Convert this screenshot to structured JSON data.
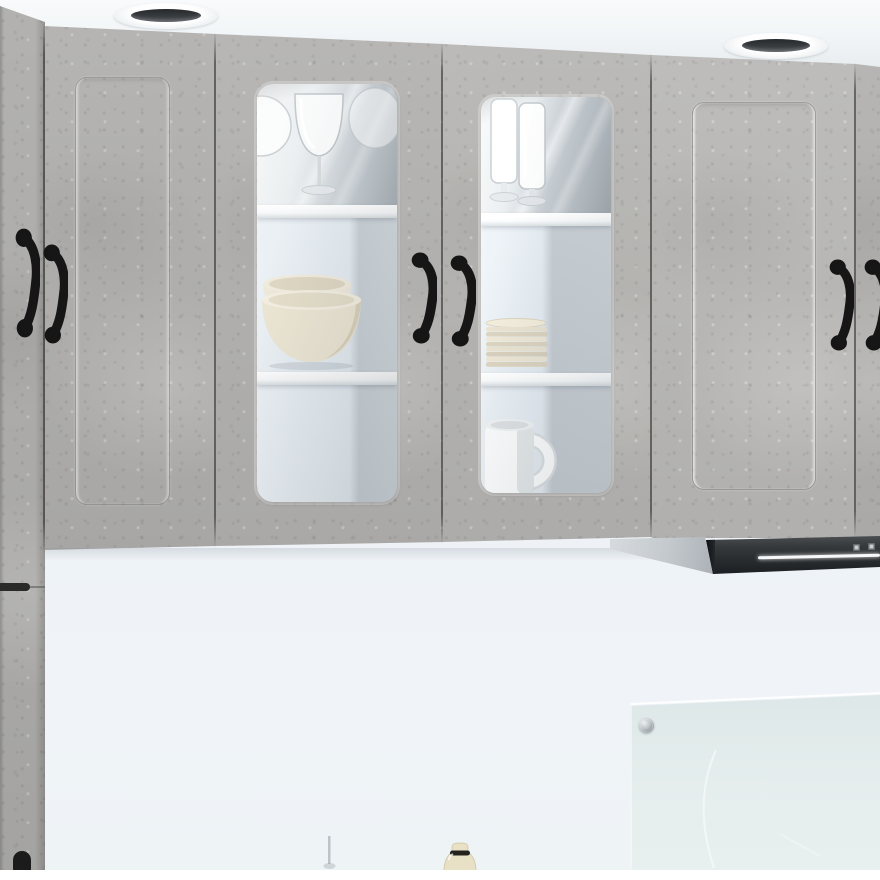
{
  "scene": {
    "label": "kitchen-cabinet-product-photo",
    "description": "Product photo of wall-mounted kitchen cabinets in a concrete-grey finish: two glass-front display doors with white shelves holding glassware and crockery, flanked by plain framed doors with black retro pull handles; a tall cabinet at the left edge, two recessed ceiling spotlights above, a black extractor hood with LED strip at lower right, and a glass splashback over a pale blue-white wall.",
    "text_visible": false,
    "image_width_px": 880,
    "image_height_px": 880
  },
  "palette": {
    "concrete_grey": "#b3b2b0",
    "ceiling_white": "#f4f7f8",
    "wall_light_blue": "#edf2f6",
    "shelf_white": "#fafbfc",
    "handle_black": "#161616",
    "hood_black": "#26292c",
    "hood_led_white": "#f6f8f9",
    "crockery_cream": "#e9e2cf",
    "mug_white": "#f7f8f8",
    "splashback_glass": "#dfeae8",
    "bottle_cream": "#e9e1c6"
  },
  "ceiling": {
    "label": "white ceiling",
    "recessed_spotlights": 2,
    "spotlight_label": "recessed spotlight"
  },
  "cabinets": {
    "finish": "concrete grey",
    "tall_cabinet": {
      "label": "tall cabinet at left edge",
      "upper_handle": "black pull handle",
      "lower_handle": "black pull handle (partially visible at bottom)"
    },
    "doors": [
      {
        "id": "door-1",
        "label": "framed panel door",
        "type": "framed-panel",
        "handle_side": "left"
      },
      {
        "id": "door-2",
        "label": "glass display door",
        "type": "glass",
        "handle_side": "right",
        "shelf_contents": [
          "red wine glasses (2)",
          "stacked cream bowls (2)",
          "empty shelf"
        ]
      },
      {
        "id": "door-3",
        "label": "glass display door",
        "type": "glass",
        "handle_side": "left",
        "shelf_contents": [
          "tall footed glasses (2)",
          "stack of cream plates (~9)",
          "white mug"
        ]
      },
      {
        "id": "door-4",
        "label": "framed panel door",
        "type": "framed-panel",
        "handle_side": "right"
      },
      {
        "id": "door-5",
        "label": "framed panel door (cropped at right edge)",
        "type": "framed-panel",
        "handle_side": "left"
      }
    ],
    "shelves_per_glass_door": 2,
    "handle_style": "black vintage cup pull",
    "visible_handle_count": 6
  },
  "extractor_hood": {
    "label": "black extractor hood",
    "led_strip": true,
    "control_buttons": 2
  },
  "splashback": {
    "label": "glass splashback panel",
    "screw_fittings": 1
  },
  "countertop_items": [
    {
      "label": "cream bottle with black band"
    },
    {
      "label": "faint glass, barely visible"
    }
  ],
  "wall": {
    "label": "pale blue-white wall"
  }
}
